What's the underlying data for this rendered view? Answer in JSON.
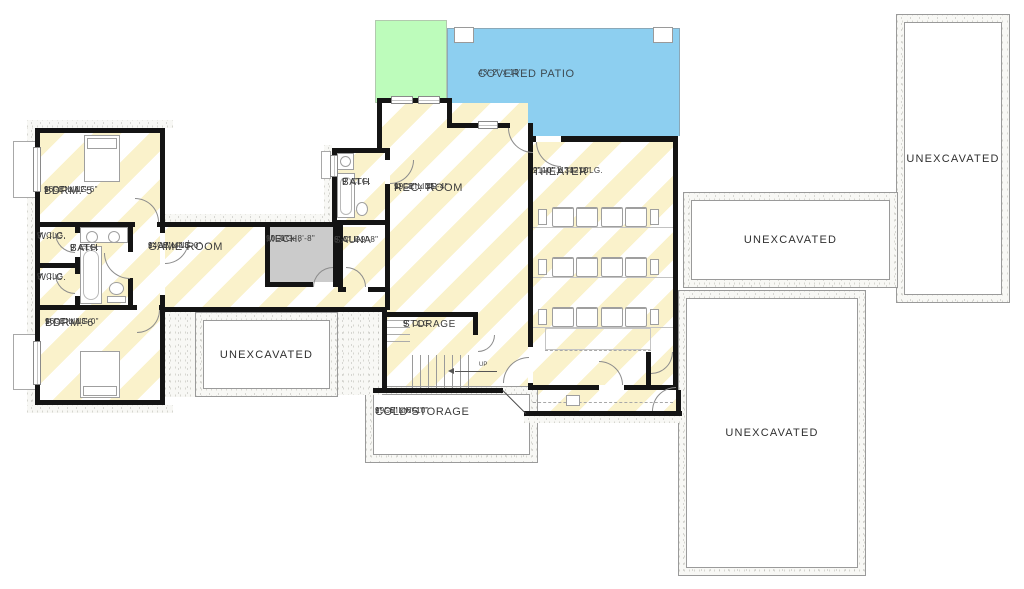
{
  "rooms": {
    "bdrm5": {
      "name": "BDRM. 5",
      "ceiling": "9' CEILING",
      "dims": "16'-0\" x 12'-6\""
    },
    "wic1": {
      "name": "W.I.C.",
      "ceiling": "9' CLG."
    },
    "bath1": {
      "name": "BATH",
      "ceiling": "9' CLG."
    },
    "wic2": {
      "name": "W.I.C.",
      "ceiling": "9' CLG"
    },
    "bdrm6": {
      "name": "BDRM. 6",
      "ceiling": "9' CEILING",
      "dims": "16'-0\" x 13'-0\""
    },
    "game": {
      "name": "GAME ROOM",
      "ceiling": "9' CEILING",
      "dims": "14'-6\" x 13'-0\""
    },
    "mech": {
      "name": "MECH.",
      "ceiling": "9' CLG.",
      "dims": "10'-0\" x 8'-8\""
    },
    "sauna": {
      "name": "SAUNA",
      "ceiling": "9' CLG.",
      "dims": "6'-0\" x 9'-8\""
    },
    "bath2": {
      "name": "BATH",
      "ceiling": "9' CLG."
    },
    "rec": {
      "name": "REC. ROOM",
      "ceiling": "9' CEILING",
      "dims": "19'-8\" x 25'-4\""
    },
    "theater": {
      "name": "THEATER",
      "ceiling": "9',10',11',12' CLG.",
      "dims": "21'-0\" x 34'-10\""
    },
    "storage": {
      "name": "STORAGE",
      "ceiling": "9' CLG."
    },
    "cold": {
      "name": "COLD STORAGE",
      "ceiling": "9' CEILING",
      "dims": "19'-6\" x 6'-10\""
    },
    "patio": {
      "name": "COVERED PATIO",
      "dims": "43'-2\" x 15'"
    }
  },
  "labels": {
    "unexcavated": "UNEXCAVATED",
    "up": "UP"
  },
  "colors": {
    "patio_blue": "#8DCFF0",
    "lawn_green": "#BDFCBB",
    "stripe_yellow": "#FAF2CB",
    "mech_gray": "#CBCBCB",
    "wall_black": "#141414"
  }
}
